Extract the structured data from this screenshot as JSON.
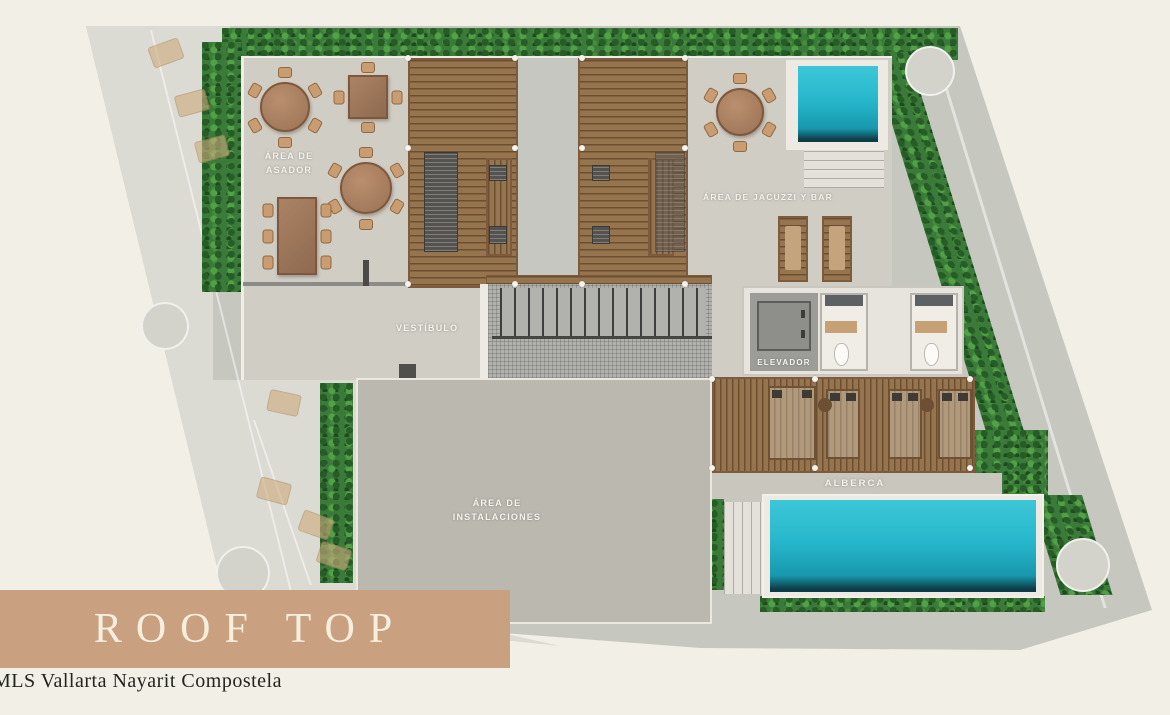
{
  "banner": {
    "title": "ROOF TOP"
  },
  "watermark": {
    "text": "MLS Vallarta Nayarit Compostela"
  },
  "plan": {
    "labels": {
      "asador": "ÁREA DE\nASADOR",
      "jacuzzi_bar": "ÁREA DE JACUZZI Y BAR",
      "vestibulo": "VESTÍBULO",
      "elevador": "ELEVADOR",
      "instalaciones": "ÁREA DE\nINSTALACIONES",
      "alberca": "ALBERCA"
    }
  },
  "colors": {
    "cream": "#f2efe6",
    "outer": "#c6c8c0",
    "faded": "#dbdad3",
    "terrace": "#d0cdc4",
    "slab": "#bbb8af",
    "foliage": "#3b7b39",
    "wood": "#96744e",
    "pool": "#27b7cc",
    "banner_bg": "#c9a181",
    "banner_text": "#f7eedd",
    "watermark": "#23231f"
  }
}
